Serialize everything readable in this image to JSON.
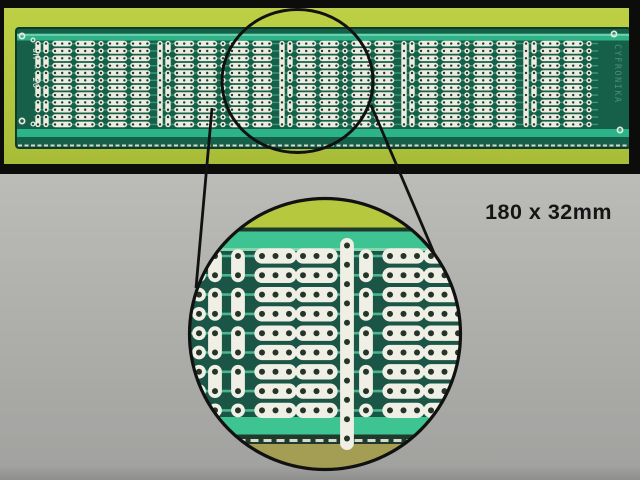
{
  "figure": {
    "type": "product-photo",
    "subject": "universal prototyping PCB with magnified detail callout",
    "dimensions_label": "180 x 32mm",
    "label_color": "#151515"
  },
  "background": {
    "top": "#cbccc8",
    "mid": "#b3b4b0",
    "bottom": "#a2a3a0",
    "bottom_edge": "#8e8f8c"
  },
  "photo": {
    "frame_color": "#0c0c0b",
    "bg_top": "#bdd045",
    "bg_bottom": "#a8bc38"
  },
  "board": {
    "marking_left": "UM - 20",
    "marking_right": "CYFRONIKA",
    "base_color": "#166049",
    "edge_color": "#0a3b2c",
    "stripe_color": "#2db388",
    "stripe_highlight": "#8fdcbe",
    "trace_color": "#3aa07e",
    "pad_color": "#edece1",
    "hole_color": "#253428",
    "tin_color": "#d9d9cd",
    "silk_color": "#e9e9df",
    "rows": 12,
    "row_start": 43.6,
    "row_pitch": 7.35,
    "pitch": 7.2,
    "pad_r": 2.7,
    "hole_r": 1.2,
    "cap_h": 5.6,
    "x_min": 34,
    "x_max": 600,
    "block_starts": [
      38,
      160,
      282,
      404,
      526
    ],
    "block_offsets": {
      "pair1": 0,
      "pair2": 8,
      "caps_a": [
        17,
        40
      ],
      "single": 63,
      "caps_b": [
        72,
        95
      ]
    },
    "corner_rings": [
      [
        22,
        36
      ],
      [
        614,
        34
      ],
      [
        22,
        121
      ],
      [
        620,
        130
      ]
    ],
    "mark_rings": [
      [
        33,
        40
      ],
      [
        33,
        124
      ]
    ]
  },
  "magnifier": {
    "ring_color": "#111111",
    "line_color": "#111111",
    "source_ring": {
      "cx": 297.5,
      "cy": 81,
      "rx": 75.5,
      "ry": 71.5
    },
    "lens": {
      "cx": 325,
      "cy": 334,
      "r": 135.5
    },
    "lines": {
      "left": [
        212,
        108,
        196,
        288
      ],
      "right": [
        371,
        105,
        437,
        260
      ]
    },
    "bands": {
      "yellow": "#b5c83e",
      "dark": "#1f3a2c",
      "teal": "#3ec493",
      "pale": "#86d6b2",
      "board": "#1b5545",
      "olive": "#a49e55",
      "tin": "#d9d9cd"
    },
    "detail": {
      "pad_color": "#f0efe6",
      "hole_color": "#253428",
      "trace_color": "#49bd93",
      "rows": 9,
      "row_start": 256,
      "row_pitch": 19.3,
      "pad_r": 6.9,
      "hole_r": 3.0,
      "cap_pitch": 13.5,
      "singles": [
        199
      ],
      "pairs": [
        215,
        238,
        366
      ],
      "caps": [
        262,
        303,
        390,
        431
      ],
      "strip_x": 347,
      "strip_top": 238,
      "strip_bottom": 450,
      "strip_hole_start": 245.5,
      "strip_hole_pitch": 19.3,
      "strip_holes": 11
    }
  }
}
